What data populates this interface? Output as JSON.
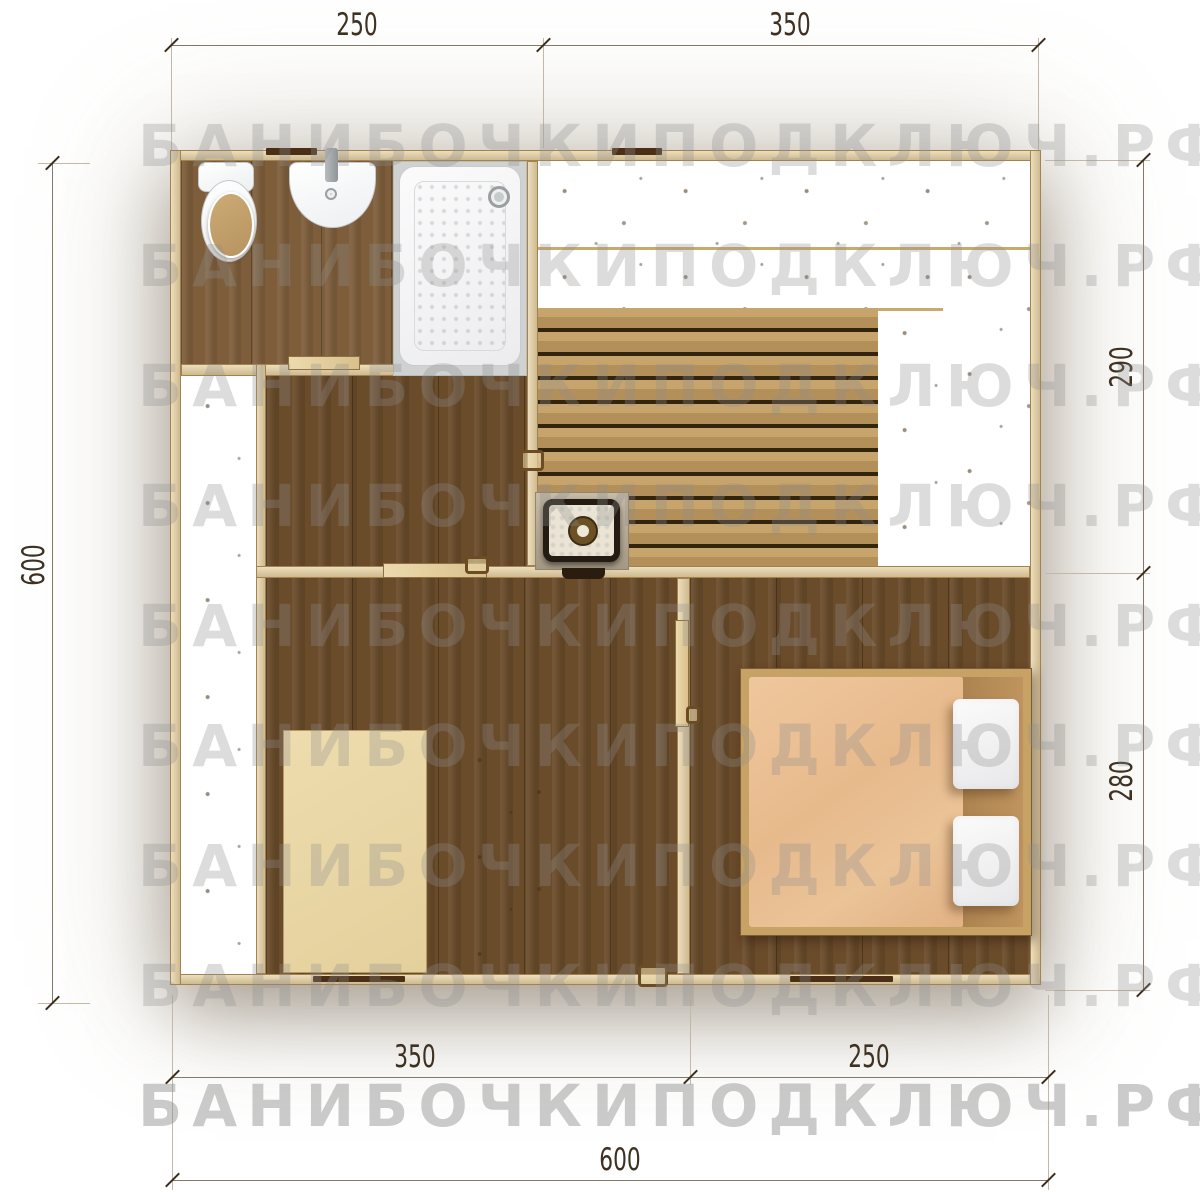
{
  "watermark": {
    "text": "БАНИБОЧКИПОДКЛЮЧ.РФ"
  },
  "dimensions": {
    "top_left": "250",
    "top_right": "350",
    "right_top": "290",
    "right_bottom": "280",
    "left_total": "600",
    "bottom_left": "350",
    "bottom_right": "250",
    "bottom_total": "600"
  },
  "objects": [
    "toilet",
    "sink",
    "shower-tray",
    "sauna-bench-upper",
    "sauna-bench-lower",
    "sauna-bench-right",
    "sauna-bench-middle",
    "sauna-stove",
    "terrace-deck",
    "table",
    "slatted-bench",
    "double-bed",
    "pillow",
    "pillow"
  ],
  "colors": {
    "wall_wood": "#e5cfa0",
    "floor_dark": "#6a4b2a",
    "floor_bath": "#7d5d3a",
    "bench_wood": "#ecd8a4",
    "deck_wood": "#d2ad79",
    "sauna_floor": "#bfa06b",
    "blanket": "#e7ba8c",
    "pillow": "#f4f4f4",
    "stove_body": "#241c12",
    "dim_text": "#3e3122",
    "watermark": "#8f8f8f"
  }
}
